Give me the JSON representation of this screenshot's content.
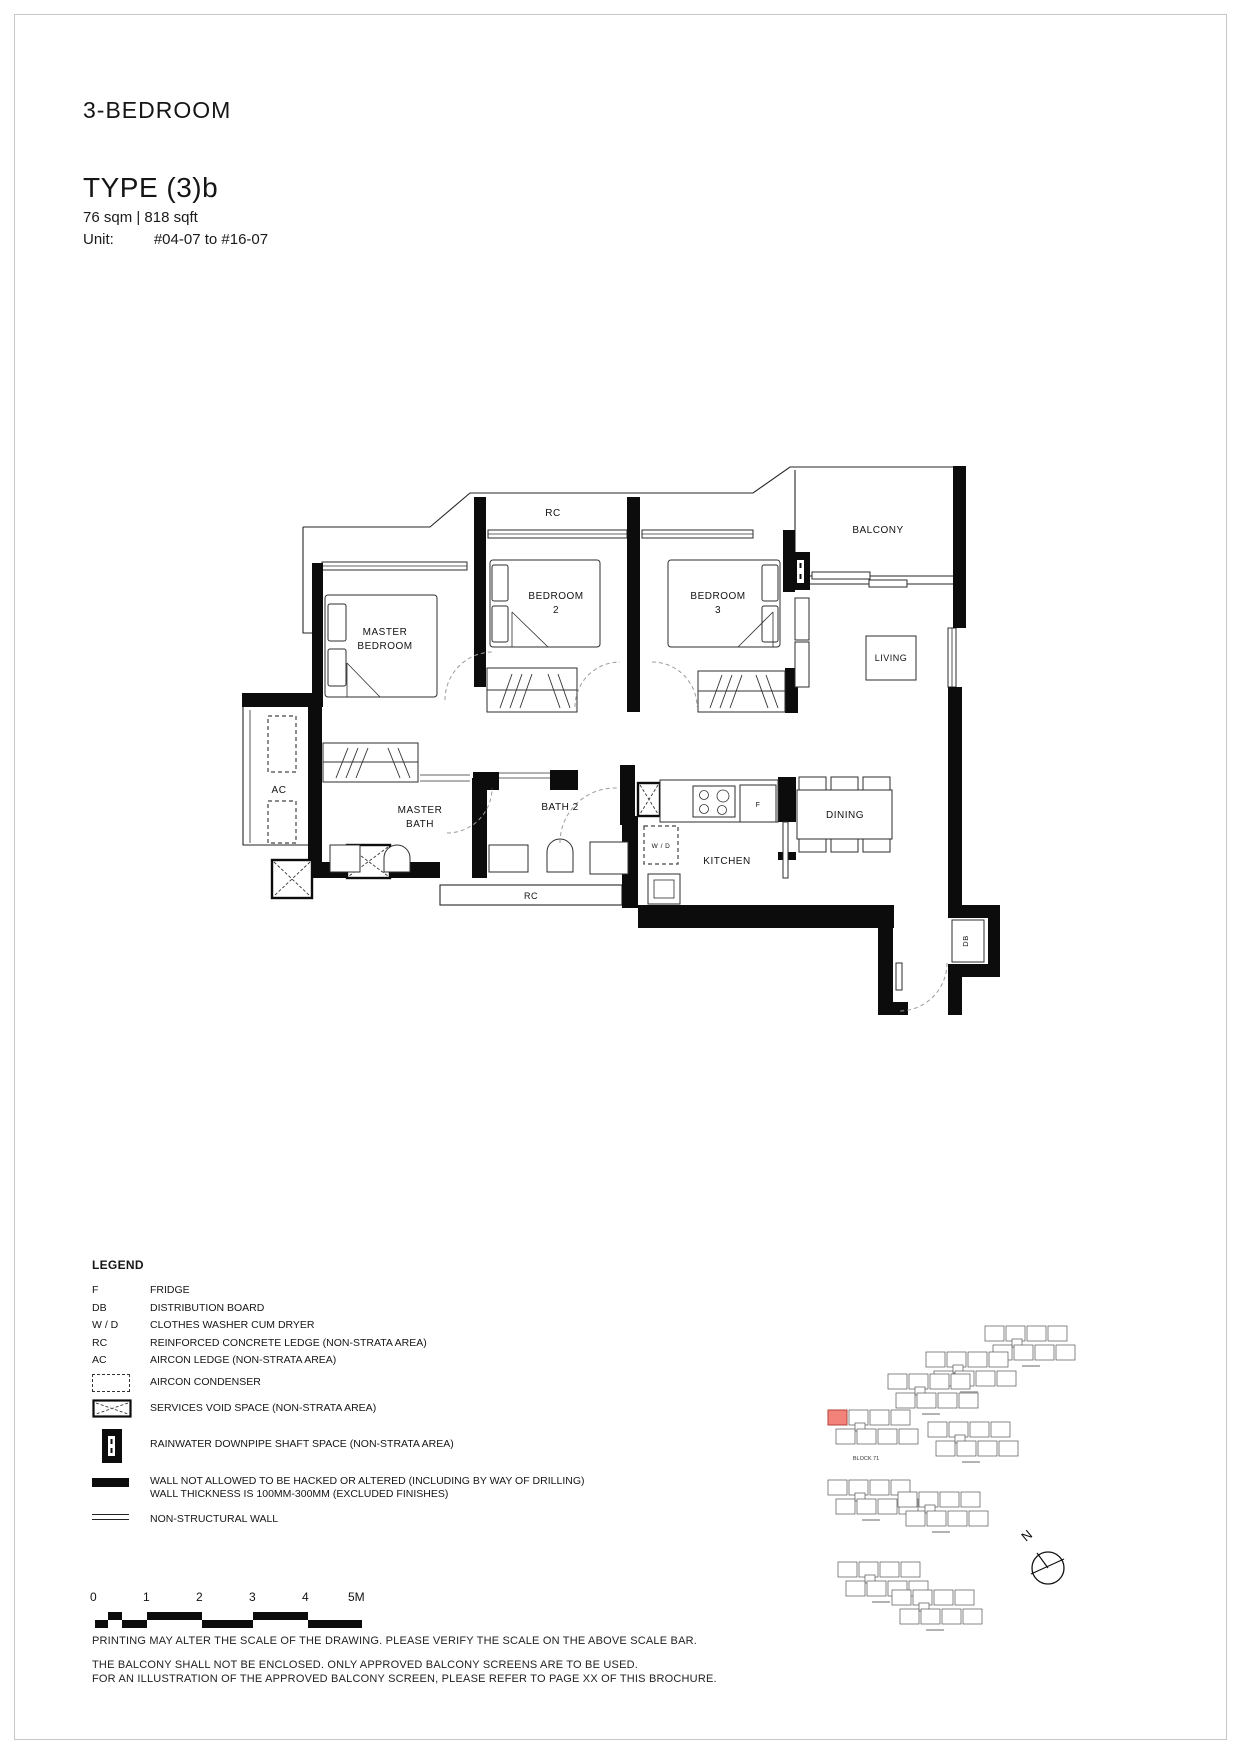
{
  "header": {
    "category": "3-BEDROOM",
    "type_label": "TYPE (3)b",
    "area": "76 sqm | 818 sqft",
    "unit_label": "Unit:",
    "unit_range": "#04-07 to #16-07"
  },
  "floorplan": {
    "labels": {
      "rc_top": "RC",
      "balcony": "BALCONY",
      "bedroom2_line1": "BEDROOM",
      "bedroom2_line2": "2",
      "bedroom3_line1": "BEDROOM",
      "bedroom3_line2": "3",
      "master_line1": "MASTER",
      "master_line2": "BEDROOM",
      "living": "LIVING",
      "ac": "AC",
      "master_bath_line1": "MASTER",
      "master_bath_line2": "BATH",
      "bath2": "BATH 2",
      "rc_bottom": "RC",
      "wd": "W / D",
      "fridge": "F",
      "kitchen": "KITCHEN",
      "dining": "DINING",
      "db": "DB"
    }
  },
  "legend": {
    "title": "LEGEND",
    "abbreviations": [
      {
        "abbr": "F",
        "desc": "FRIDGE"
      },
      {
        "abbr": "DB",
        "desc": "DISTRIBUTION BOARD"
      },
      {
        "abbr": "W / D",
        "desc": "CLOTHES WASHER CUM DRYER"
      },
      {
        "abbr": "RC",
        "desc": "REINFORCED CONCRETE LEDGE (NON-STRATA AREA)"
      },
      {
        "abbr": "AC",
        "desc": "AIRCON LEDGE (NON-STRATA AREA)"
      }
    ],
    "symbols": [
      {
        "icon": "aircon-condenser",
        "desc": "AIRCON CONDENSER"
      },
      {
        "icon": "services-void",
        "desc": "SERVICES VOID SPACE (NON-STRATA AREA)"
      },
      {
        "icon": "rainwater-downpipe",
        "desc": "RAINWATER DOWNPIPE SHAFT SPACE (NON-STRATA AREA)"
      },
      {
        "icon": "structural-wall",
        "desc": "WALL NOT ALLOWED TO BE HACKED OR ALTERED (INCLUDING BY WAY OF DRILLING)",
        "desc2": "WALL THICKNESS IS 100MM-300MM (EXCLUDED FINISHES)"
      },
      {
        "icon": "non-structural-wall",
        "desc": "NON-STRUCTURAL WALL"
      }
    ]
  },
  "scale_bar": {
    "ticks": [
      "0",
      "1",
      "2",
      "3",
      "4",
      "5M"
    ]
  },
  "site_plan": {
    "highlight_block_label": "BLOCK 71",
    "north_label": "N",
    "highlight_color": "#F2827A"
  },
  "notes": [
    "PRINTING MAY ALTER THE SCALE OF THE DRAWING. PLEASE VERIFY THE SCALE ON THE ABOVE SCALE BAR.",
    "THE BALCONY SHALL NOT BE ENCLOSED. ONLY APPROVED BALCONY SCREENS ARE TO BE USED.",
    "FOR AN ILLUSTRATION OF THE APPROVED BALCONY SCREEN, PLEASE REFER TO PAGE XX OF THIS BROCHURE."
  ],
  "colors": {
    "wall": "#0c0c0c",
    "highlight_unit": "#F2827A"
  }
}
